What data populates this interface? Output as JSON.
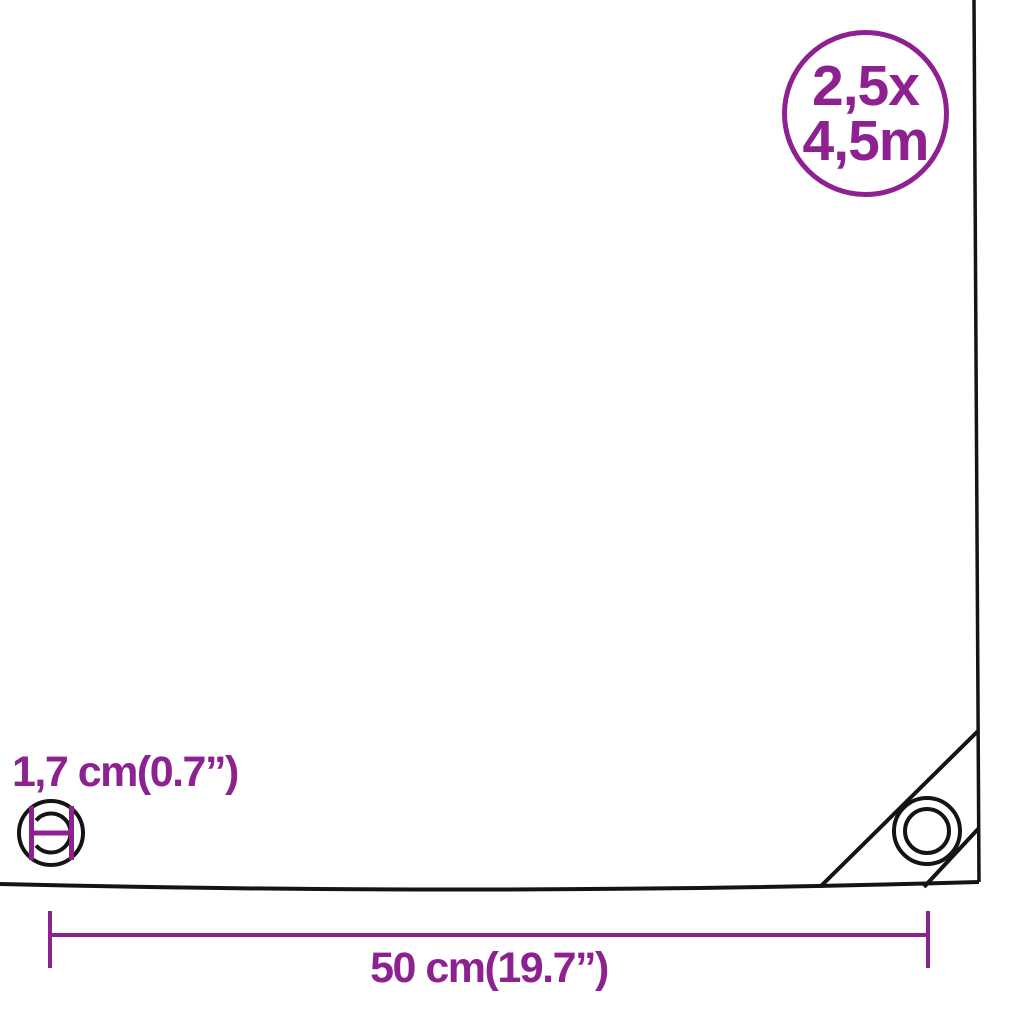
{
  "badge": {
    "line1": "2,5x",
    "line2": "4,5m"
  },
  "labels": {
    "eyelet_diameter": "1,7 cm(0.7”)",
    "edge_width": "50 cm(19.7”)"
  },
  "icons": {
    "eyelet": "double-circle-grommet",
    "diameter_marker": "h-bar-caliper",
    "dimension_line": "capped-measure-line"
  },
  "colors": {
    "accent": "#8E2190",
    "line": "#141414",
    "fill": "#FFFFFF"
  }
}
